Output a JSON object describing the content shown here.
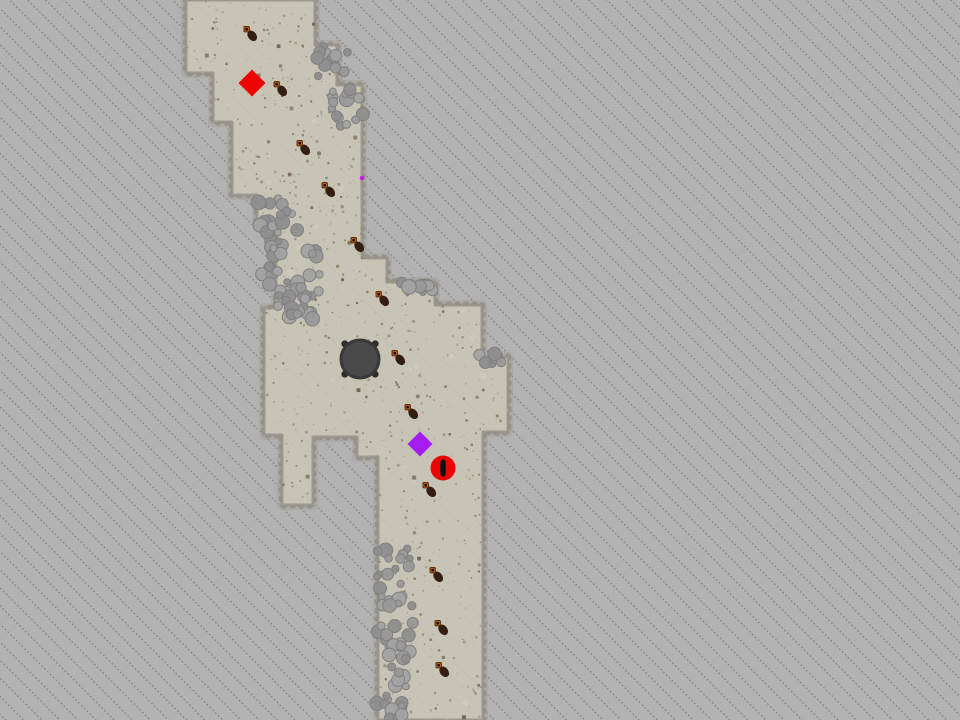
{
  "scene": {
    "kind": "top-down-game-map-with-fog-of-war",
    "width": 960,
    "height": 720,
    "colors": {
      "fog": "#b2b2b2",
      "fog_hatch": "#787878",
      "terrain": "#c8c4b5",
      "terrain_edge_soft": "#a6a39a",
      "terrain_edge_bumps": "#8f8c82",
      "terrain_edge_line": "#97948a"
    }
  },
  "terrain": {
    "outline": [
      [
        186,
        0
      ],
      [
        315,
        0
      ],
      [
        315,
        45
      ],
      [
        337,
        45
      ],
      [
        337,
        85
      ],
      [
        362,
        85
      ],
      [
        362,
        258
      ],
      [
        387,
        258
      ],
      [
        387,
        282
      ],
      [
        435,
        282
      ],
      [
        435,
        305
      ],
      [
        482,
        305
      ],
      [
        482,
        357
      ],
      [
        508,
        357
      ],
      [
        508,
        432
      ],
      [
        483,
        432
      ],
      [
        483,
        720
      ],
      [
        378,
        720
      ],
      [
        378,
        457
      ],
      [
        357,
        457
      ],
      [
        357,
        437
      ],
      [
        313,
        437
      ],
      [
        313,
        505
      ],
      [
        282,
        505
      ],
      [
        282,
        435
      ],
      [
        264,
        435
      ],
      [
        264,
        308
      ],
      [
        276,
        308
      ],
      [
        276,
        225
      ],
      [
        257,
        225
      ],
      [
        257,
        195
      ],
      [
        232,
        195
      ],
      [
        232,
        122
      ],
      [
        213,
        122
      ],
      [
        213,
        73
      ],
      [
        186,
        73
      ]
    ],
    "speckle_colors": [
      "#b0a996",
      "#a19a86",
      "#918a77",
      "#7e7664",
      "#6d6350",
      "#bab4a3",
      "#857b66"
    ],
    "pebble_colors": [
      "#6d5f49",
      "#7b6c52",
      "#5f5340"
    ],
    "light_patch_color": "#d4d0c1"
  },
  "rocks": {
    "fill_colors": [
      "#a3a3a3",
      "#999999",
      "#8f8f8f"
    ],
    "stroke": "#7f7f7f",
    "clusters": [
      {
        "x": 316,
        "y": 40,
        "w": 32,
        "h": 38,
        "n": 13
      },
      {
        "x": 331,
        "y": 86,
        "w": 33,
        "h": 42,
        "n": 15
      },
      {
        "x": 256,
        "y": 198,
        "w": 46,
        "h": 50,
        "n": 20
      },
      {
        "x": 260,
        "y": 244,
        "w": 60,
        "h": 48,
        "n": 22
      },
      {
        "x": 278,
        "y": 282,
        "w": 42,
        "h": 40,
        "n": 17
      },
      {
        "x": 283,
        "y": 297,
        "w": 33,
        "h": 20,
        "n": 9
      },
      {
        "x": 400,
        "y": 281,
        "w": 34,
        "h": 16,
        "n": 9
      },
      {
        "x": 476,
        "y": 350,
        "w": 30,
        "h": 14,
        "n": 7
      },
      {
        "x": 377,
        "y": 547,
        "w": 33,
        "h": 55,
        "n": 17
      },
      {
        "x": 377,
        "y": 598,
        "w": 37,
        "h": 54,
        "n": 18
      },
      {
        "x": 377,
        "y": 650,
        "w": 29,
        "h": 55,
        "n": 14
      },
      {
        "x": 377,
        "y": 700,
        "w": 25,
        "h": 20,
        "n": 8
      }
    ]
  },
  "creatures": {
    "body_color": "#341d11",
    "head_ring_color": "#5c2d08",
    "head_color": "#c2651a",
    "head_center_color": "#1f0f08",
    "positions": [
      [
        250,
        33
      ],
      [
        280,
        88
      ],
      [
        303,
        147
      ],
      [
        328,
        189
      ],
      [
        357,
        244
      ],
      [
        382,
        298
      ],
      [
        398,
        357
      ],
      [
        411,
        411
      ],
      [
        429,
        489
      ],
      [
        436,
        574
      ],
      [
        441,
        627
      ],
      [
        442,
        669
      ]
    ]
  },
  "structure": {
    "x": 360,
    "y": 359,
    "r": 19,
    "fill": "#4a4a4a",
    "rim": "#393939",
    "feet": "#2c2c2c"
  },
  "markers": [
    {
      "name": "red-diamond-marker",
      "shape": "diamond",
      "x": 252,
      "y": 83,
      "half": 13.5,
      "color": "#ee0202"
    },
    {
      "name": "purple-diamond-marker",
      "shape": "diamond",
      "x": 420,
      "y": 444,
      "half": 12.5,
      "color": "#a51df2"
    },
    {
      "name": "alert-marker",
      "shape": "alert-circle",
      "x": 443,
      "y": 468,
      "r": 12.5,
      "color": "#ee0202",
      "bar_color": "#0d0d0d"
    },
    {
      "name": "small-magenta-dot",
      "shape": "dot",
      "x": 362,
      "y": 178,
      "r": 2.3,
      "color": "#c21ce8"
    }
  ]
}
